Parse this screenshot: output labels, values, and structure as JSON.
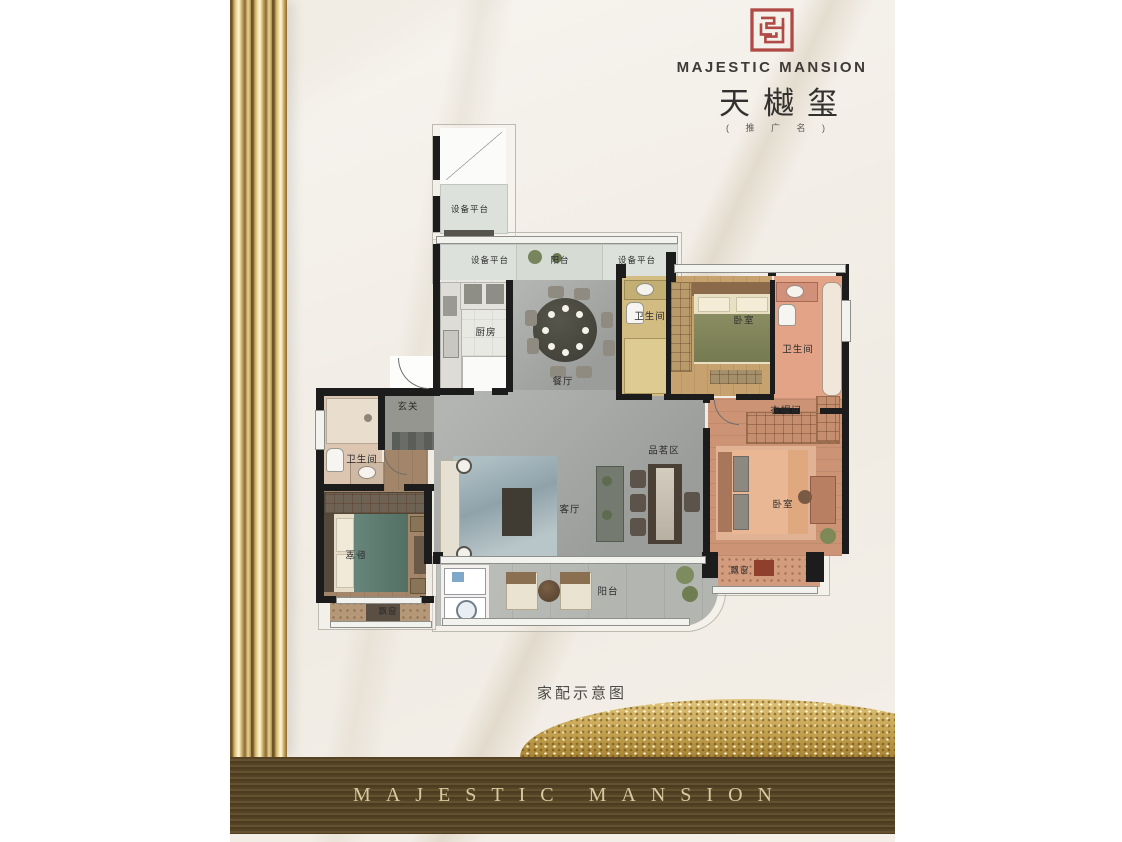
{
  "brand": {
    "logo_en": "MAJESTIC MANSION",
    "logo_cn": "天樾玺",
    "logo_sub": "( 推 广 名 )",
    "footer": "MAJESTIC MANSION"
  },
  "caption": "家配示意图",
  "rooms": {
    "equip_top": "设备平台",
    "equip_left": "设备平台",
    "balcony_top": "阳台",
    "equip_right": "设备平台",
    "kitchen": "厨房",
    "dining": "餐厅",
    "bath_top": "卫生间",
    "bedroom_top": "卧室",
    "bath_ensuite": "卫生间",
    "foyer": "玄关",
    "bath_left": "卫生间",
    "cloakroom": "衣帽间",
    "tea_area": "品茗区",
    "living": "客厅",
    "bedroom_master": "卧室",
    "bedroom_left": "卧室",
    "bay_left": "飘窗",
    "bay_master": "飘窗",
    "balcony_bottom": "阳台"
  },
  "colors": {
    "seal": "#b04a46",
    "gold": "#c9a956",
    "band": "#5a4728",
    "wall": "#1c1c1c"
  }
}
